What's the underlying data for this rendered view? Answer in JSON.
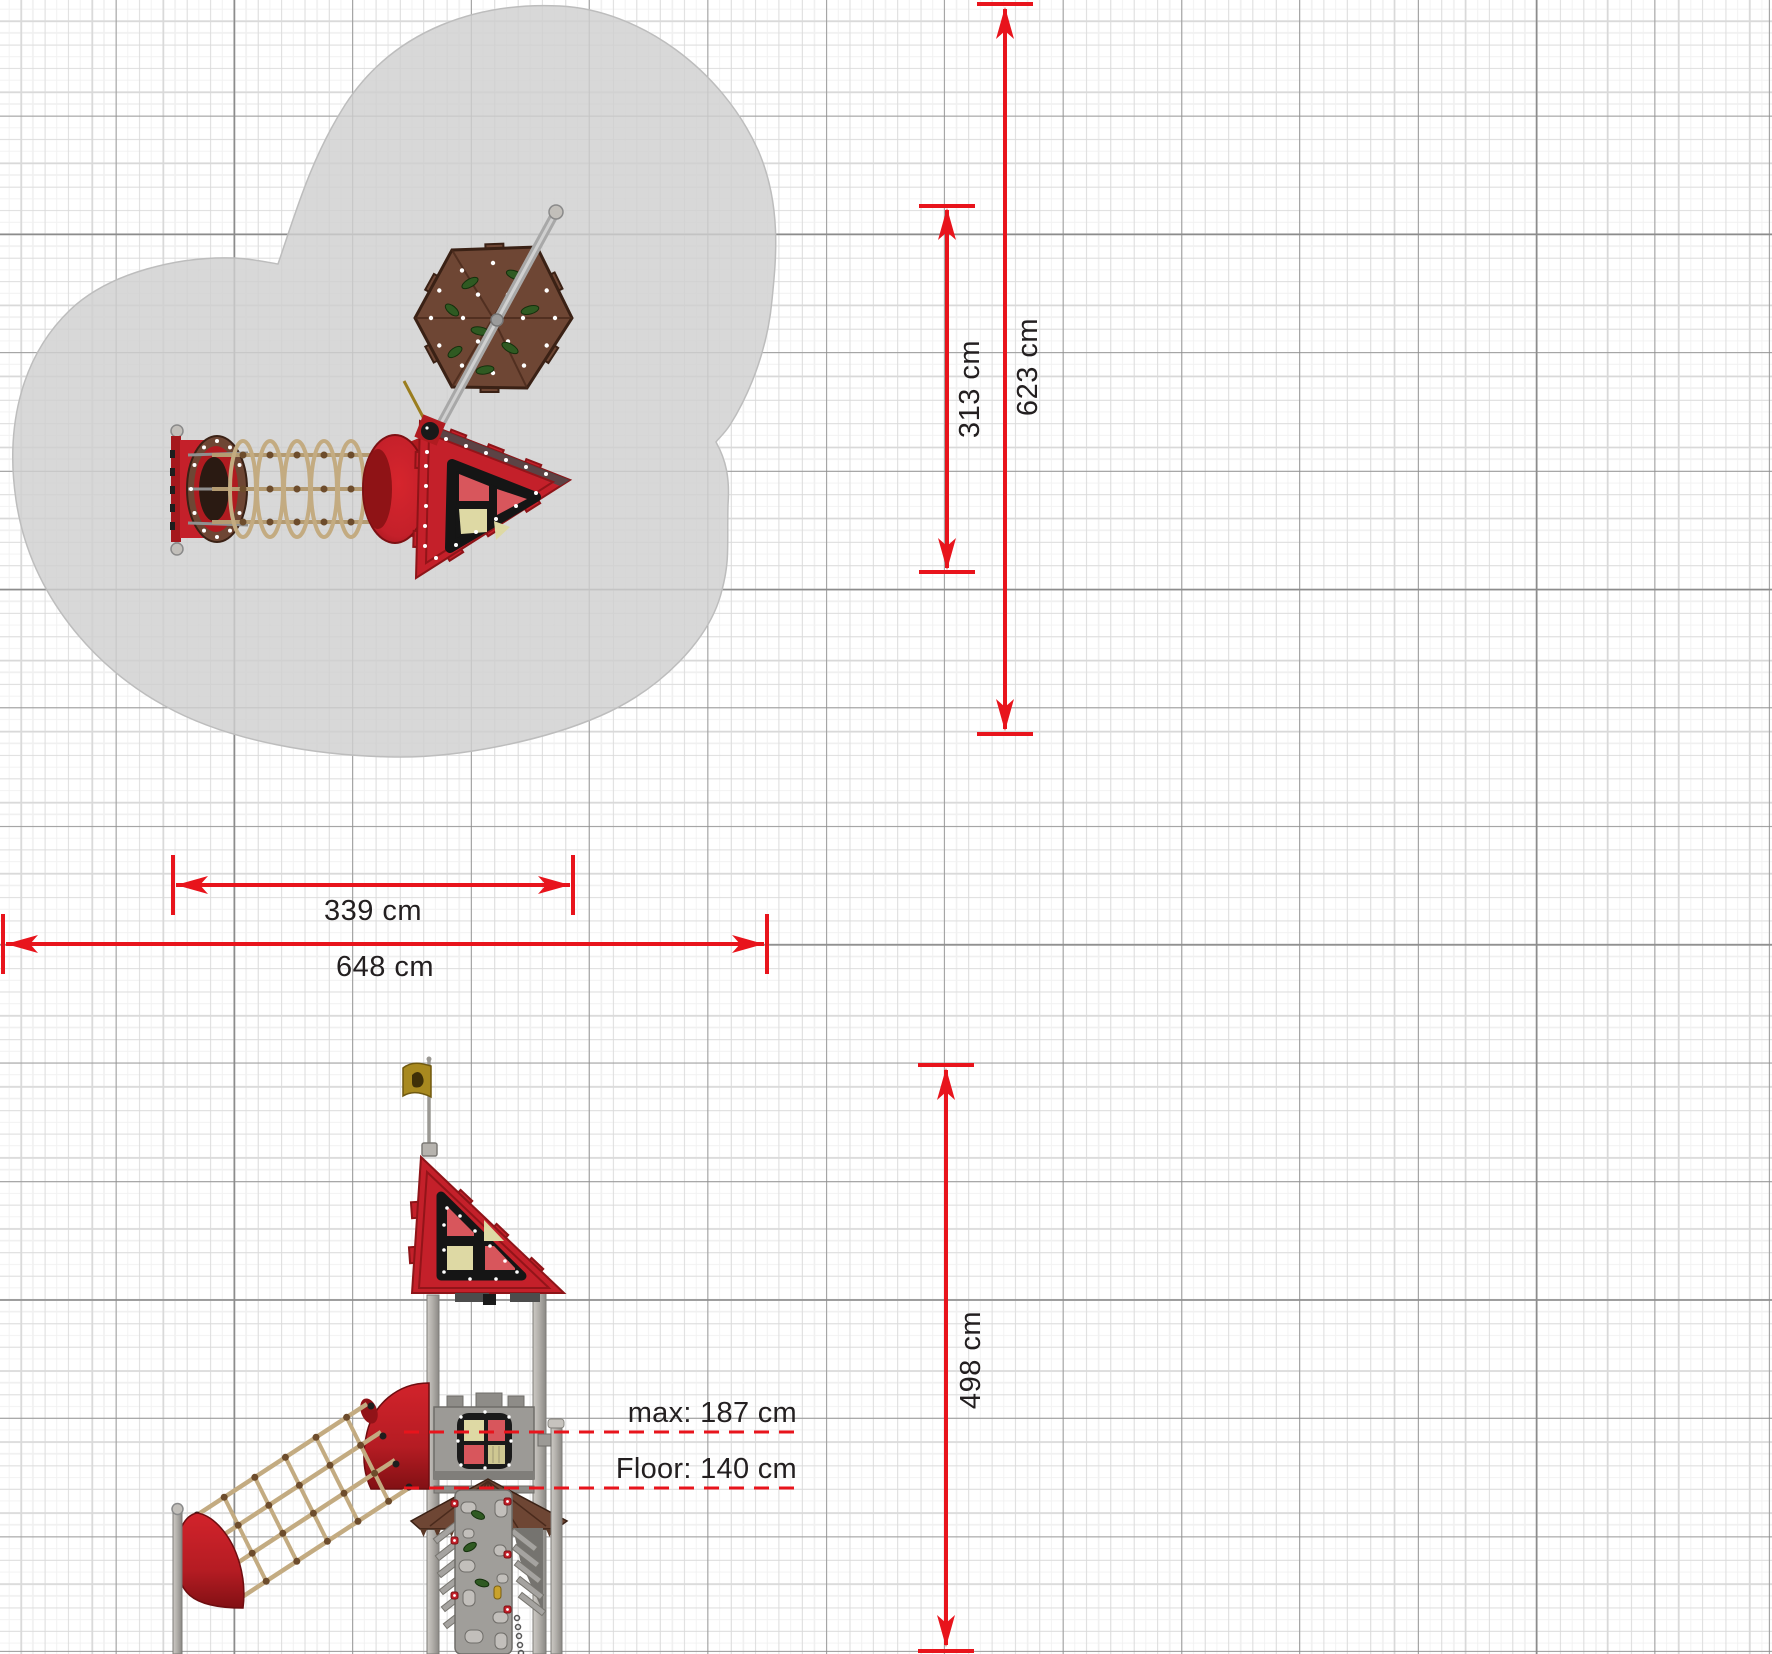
{
  "drawing": {
    "plan": {
      "dim_depth_inner": "313 cm",
      "dim_depth_outer": "623 cm",
      "dim_width_inner": "339 cm",
      "dim_width_outer": "648 cm"
    },
    "elevation": {
      "dim_height_total": "498 cm",
      "label_max": "max: 187 cm",
      "label_floor": "Floor: 140 cm"
    },
    "colors": {
      "dimension_red": "#e8141c",
      "equipment_red": "#c4202a",
      "equipment_red_dark": "#8c1216",
      "wood_brown": "#6e4634",
      "rope_tan": "#c3ab81",
      "pane_beige": "#ded9a4",
      "pane_red": "#d8565c",
      "safety_zone_gray": "#d4d4d4",
      "grid_major": "#8c8c8c",
      "grid_minor": "#d9d9d9"
    }
  }
}
